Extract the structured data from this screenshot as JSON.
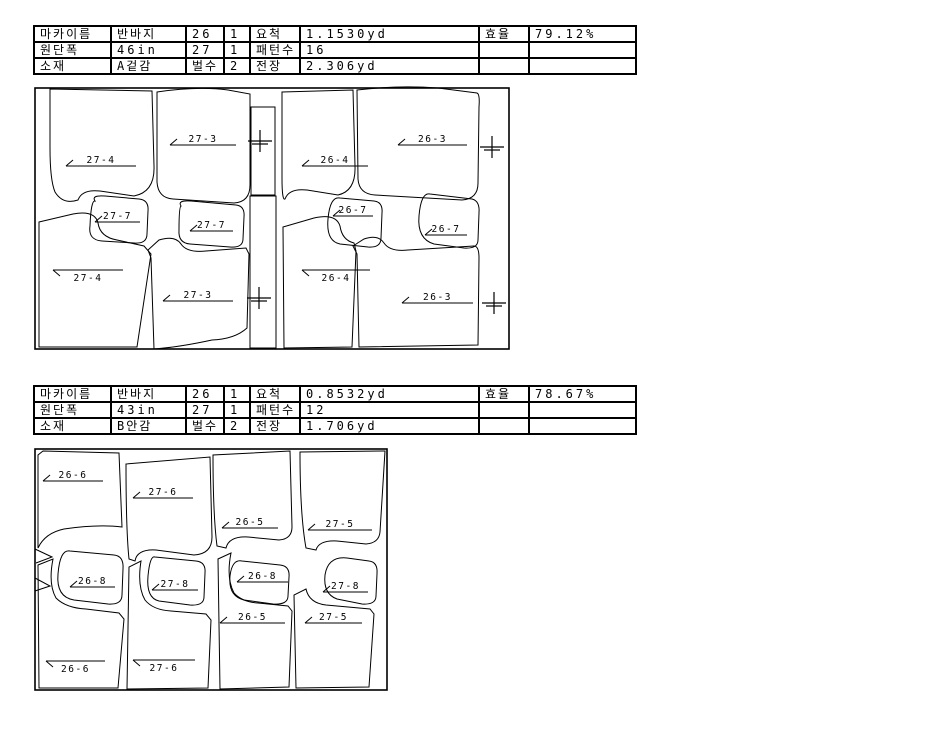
{
  "colors": {
    "line": "#000000",
    "background": "#ffffff",
    "text": "#000000"
  },
  "table_columns": [
    77,
    75,
    38,
    26,
    50,
    179,
    50,
    107
  ],
  "markers": [
    {
      "id": "A",
      "table_rows": [
        [
          "마카이름",
          "반바지",
          "26",
          "1",
          "요척",
          "1.1530yd",
          "효율",
          "79.12%"
        ],
        [
          "원단폭",
          "46in",
          "27",
          "1",
          "패턴수",
          "16",
          "",
          ""
        ],
        [
          "소재",
          "A겉감",
          "벌수",
          "2",
          "전장",
          "2.306yd",
          "",
          ""
        ]
      ],
      "layout": {
        "view": [
          28,
          84,
          490,
          270
        ],
        "outer": [
          35,
          88,
          474,
          261
        ],
        "pieces": [
          {
            "label": "27-4",
            "side": "above",
            "label_line": [
              66,
              136,
              166
            ],
            "outline": "M50,89 L152,91 L154,166 Q155,192 134,196 L100,191 Q82,189 78,200 Q63,205 55,192 Q50,180 50,148 Z"
          },
          {
            "label": "27-3",
            "side": "above",
            "label_line": [
              170,
              236,
              145
            ],
            "outline": "M157,92 Q198,86 228,90 L250,94 L250,185 Q250,202 234,203 L173,199 Q158,198 157,182 Z"
          },
          {
            "label": "27-7",
            "side": "above",
            "label_line": [
              95,
              140,
              222
            ],
            "outline": "M95,201 Q91,195 105,196 L139,199 Q149,200 148,211 L147,234 Q147,244 134,243 L102,241 Q88,240 90,226 Q91,200 95,201 Z"
          },
          {
            "label": "27-7",
            "side": "above",
            "label_line": [
              190,
              233,
              231
            ],
            "outline": "M181,206 Q177,200 191,201 L236,205 Q245,206 244,217 L243,239 Q243,248 230,247 L190,244 Q178,243 179,230 Q179,207 181,206 Z"
          },
          {
            "label": "27-4",
            "side": "below",
            "label_line": [
              53,
              123,
              270
            ],
            "outline": "M39,222 L73,214 Q95,210 98,223 Q100,237 117,240 L144,246 L151,254 L137,347 L39,347 Z"
          },
          {
            "label": "27-3",
            "side": "above",
            "label_line": [
              163,
              233,
              301
            ],
            "outline": "M154,349 L151,258 L148,250 L159,240 Q175,235 181,244 Q187,253 206,251 L246,248 L249,254 L247,328 Q235,339 212,340 Q180,347 154,349 Z"
          },
          {
            "label": "",
            "side": "above",
            "label_line": null,
            "outline": "M251,107 L275,107 L275,195 L251,195 Z"
          },
          {
            "label": "",
            "side": "above",
            "label_line": null,
            "outline": "M250,196 L276,196 L276,348 L250,348 Z"
          },
          {
            "label": "26-4",
            "side": "above",
            "label_line": [
              302,
              368,
              166
            ],
            "outline": "M282,92 L353,90 L355,166 Q356,191 338,195 L307,190 Q289,188 285,199 Q282,201 282,178 Z"
          },
          {
            "label": "26-3",
            "side": "above",
            "label_line": [
              398,
              467,
              145
            ],
            "outline": "M357,90 Q398,85 438,88 L477,93 Q480,94 479,107 L478,183 Q478,199 462,200 L375,195 Q359,194 358,179 Z"
          },
          {
            "label": "26-7",
            "side": "above",
            "label_line": [
              333,
              373,
              216
            ],
            "outline": "M340,198 L374,201 Q383,202 382,213 L381,238 Q381,248 368,247 L340,244 Q326,241 328,219 Q330,196 340,198 Z"
          },
          {
            "label": "26-7",
            "side": "above",
            "label_line": [
              425,
              467,
              235
            ],
            "outline": "M430,194 L472,199 Q480,201 479,213 L478,240 Q478,249 464,248 L434,244 Q417,239 419,216 Q421,192 430,194 Z"
          },
          {
            "label": "26-4",
            "side": "below",
            "label_line": [
              302,
              370,
              270
            ],
            "outline": "M284,348 L283,227 L314,218 Q336,213 340,226 Q342,240 354,243 L356,251 L352,347 Z"
          },
          {
            "label": "26-3",
            "side": "above",
            "label_line": [
              402,
              473,
              303
            ],
            "outline": "M359,347 L357,254 L353,246 L364,239 Q378,234 384,243 Q390,252 408,250 L474,246 Q479,246 479,258 L478,345 Z"
          }
        ],
        "crosses": [
          [
            260,
            141
          ],
          [
            259,
            298
          ],
          [
            492,
            147
          ],
          [
            494,
            303
          ]
        ],
        "notches": []
      }
    },
    {
      "id": "B",
      "table_rows": [
        [
          "마카이름",
          "반바지",
          "26",
          "1",
          "요척",
          "0.8532yd",
          "효율",
          "78.67%"
        ],
        [
          "원단폭",
          "43in",
          "27",
          "1",
          "패턴수",
          "12",
          "",
          ""
        ],
        [
          "소재",
          "B안감",
          "벌수",
          "2",
          "전장",
          "1.706yd",
          "",
          ""
        ]
      ],
      "layout": {
        "view": [
          28,
          444,
          368,
          252
        ],
        "outer": [
          35,
          449,
          352,
          241
        ],
        "pieces": [
          {
            "label": "26-6",
            "side": "above",
            "label_line": [
              43,
              103,
              481
            ],
            "outline": "M38,548 L38,455 L43,451 L119,453 L122,527 Q98,524 64,529 Q45,533 38,548 Z"
          },
          {
            "label": "27-6",
            "side": "above",
            "label_line": [
              133,
              193,
              498
            ],
            "outline": "M129,559 Q126,530 126,464 L210,457 L212,537 Q212,554 194,555 L156,550 Q137,549 135,561 Z"
          },
          {
            "label": "26-5",
            "side": "above",
            "label_line": [
              222,
              278,
              528
            ],
            "outline": "M217,546 Q213,515 213,455 L290,451 L292,527 Q292,539 279,540 L248,537 Q229,536 226,548 Z"
          },
          {
            "label": "27-5",
            "side": "above",
            "label_line": [
              308,
              372,
              530
            ],
            "outline": "M306,548 Q300,515 300,452 L385,451 L380,532 Q379,543 366,544 L337,541 Q319,540 316,550 Z"
          },
          {
            "label": "26-8",
            "side": "above",
            "label_line": [
              70,
              115,
              587
            ],
            "outline": "M70,551 L114,555 Q124,556 123,569 L122,595 Q122,605 108,604 L74,600 Q56,597 58,574 Q60,549 70,551 Z"
          },
          {
            "label": "27-8",
            "side": "above",
            "label_line": [
              152,
              198,
              590
            ],
            "outline": "M155,557 L196,561 Q206,562 205,573 L204,597 Q204,606 190,605 L159,601 Q146,598 148,576 Q150,555 155,557 Z"
          },
          {
            "label": "26-8",
            "side": "above",
            "label_line": [
              237,
              288,
              582
            ],
            "outline": "M242,561 L280,565 Q290,566 289,577 L288,596 Q288,605 273,604 L244,600 Q228,596 230,576 Q232,559 242,561 Z"
          },
          {
            "label": "27-8",
            "side": "above",
            "label_line": [
              323,
              368,
              592
            ],
            "outline": "M347,558 L369,561 Q378,562 377,574 L376,596 Q376,605 362,604 L337,599 Q323,594 325,575 Q328,556 347,558 Z"
          },
          {
            "label": "26-6",
            "side": "below",
            "label_line": [
              46,
              105,
              661
            ],
            "outline": "M39,688 L38,565 L53,559 Q48,584 56,598 Q66,608 86,609 L119,613 L124,619 L118,688 Z"
          },
          {
            "label": "27-6",
            "side": "below",
            "label_line": [
              133,
              195,
              660
            ],
            "outline": "M127,689 L129,567 L141,561 Q137,586 145,600 Q153,610 171,611 L206,614 L211,620 L208,688 Z"
          },
          {
            "label": "26-5",
            "side": "above",
            "label_line": [
              220,
              285,
              623
            ],
            "outline": "M220,689 L218,559 L231,553 Q226,578 234,593 Q242,602 258,603 L288,606 L292,611 L289,687 Z"
          },
          {
            "label": "27-5",
            "side": "above",
            "label_line": [
              305,
              362,
              623
            ],
            "outline": "M296,688 L294,595 L306,589 Q309,603 326,605 L370,609 L374,614 L369,687 Z"
          }
        ],
        "crosses": [],
        "notches": [
          "M35,549 L52,557 L36,563",
          "M35,578 L50,586 L35,591"
        ]
      }
    }
  ]
}
